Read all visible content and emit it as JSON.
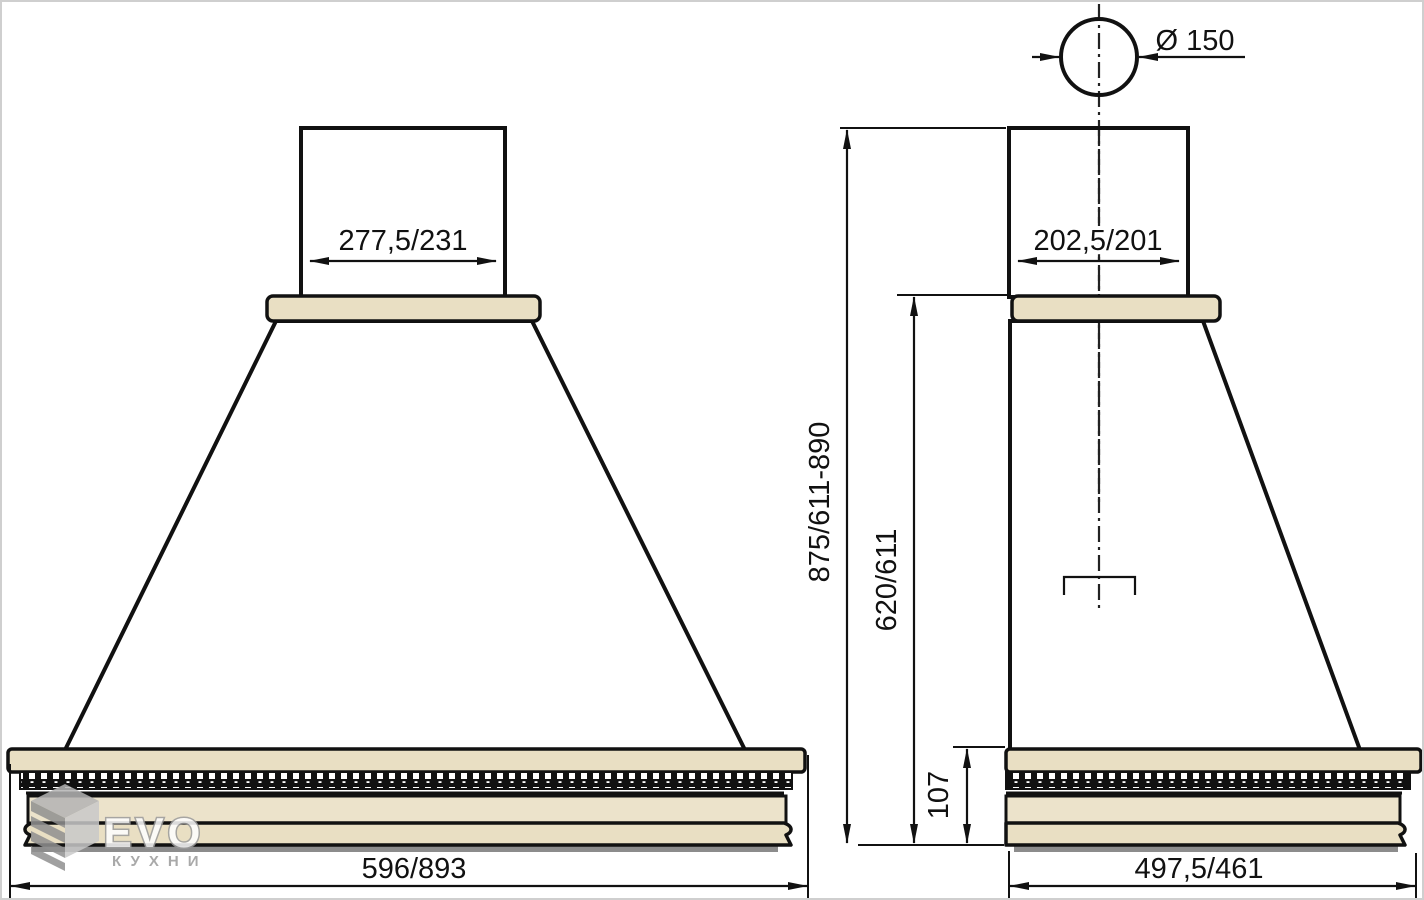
{
  "front_view": {
    "duct_width": "277,5/231",
    "overall_width": "596/893"
  },
  "side_view": {
    "duct_depth": "202,5/201",
    "overall_depth": "497,5/461",
    "flue_diameter": "Ø 150",
    "overall_height": "875/611-890",
    "canopy_height": "620/611",
    "cornice_height": "107"
  },
  "logo": {
    "brand": "EVO",
    "subtitle": "КУХНИ"
  },
  "colors": {
    "wood_beige": "#e9dfc3",
    "shadow_gray": "#8c8c8c",
    "logo_gray": "#9b9b9b",
    "line_black": "#111111"
  }
}
